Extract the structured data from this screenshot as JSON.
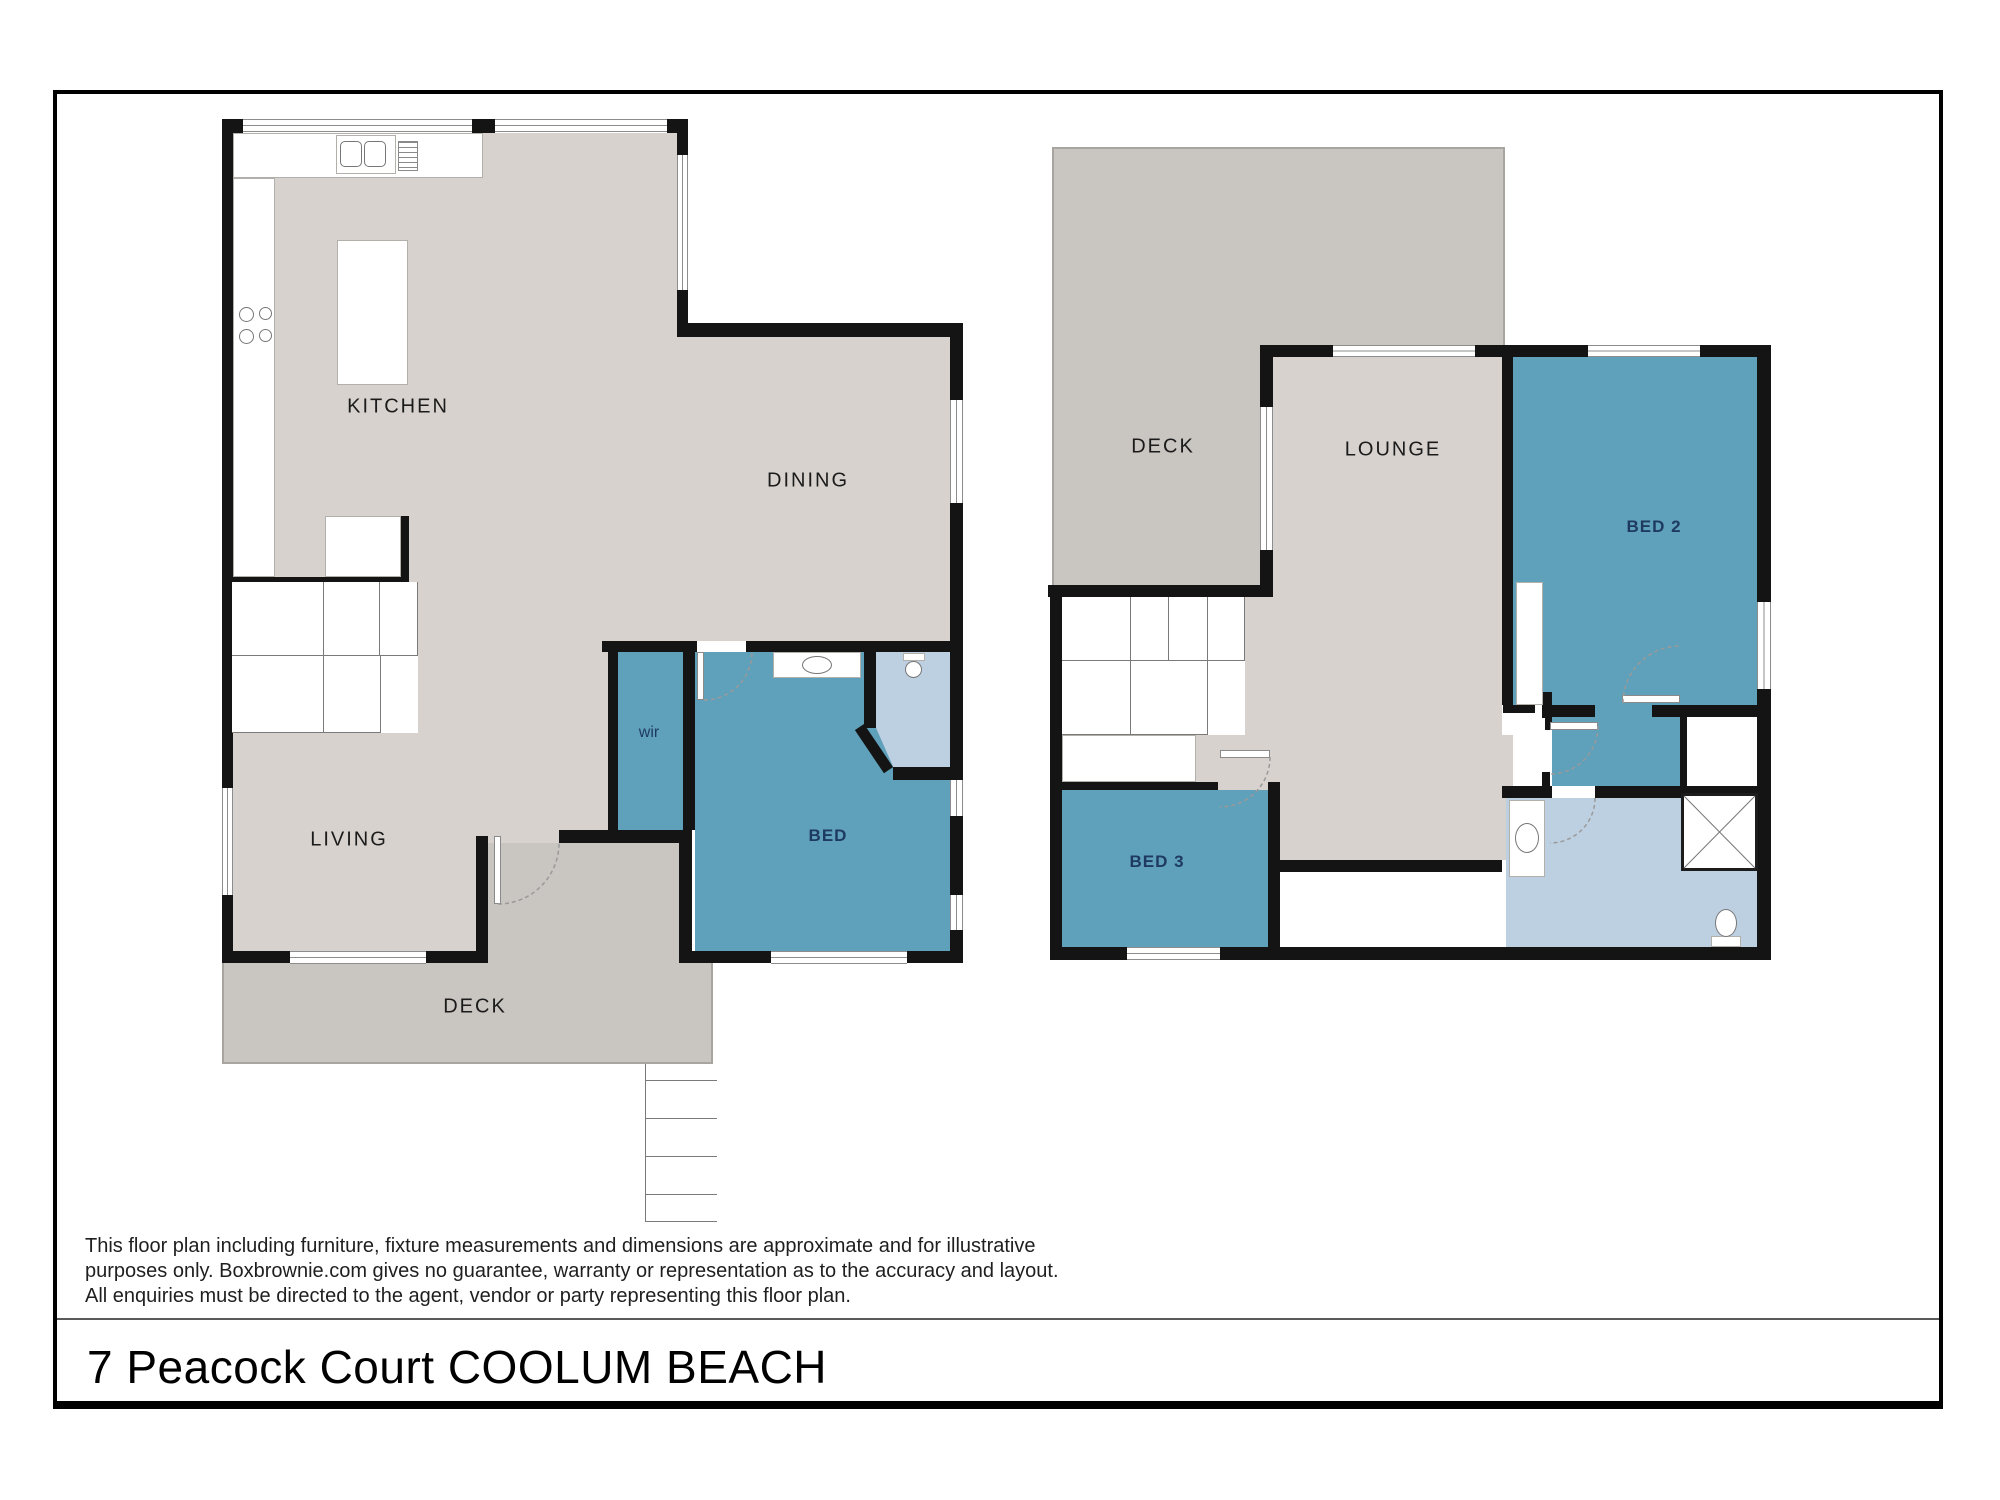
{
  "title": "7 Peacock Court COOLUM BEACH",
  "disclaimer": {
    "line1": "This floor plan including furniture, fixture measurements and dimensions are approximate and for illustrative",
    "line2": "purposes only. Boxbrownie.com gives no guarantee, warranty or representation as to the accuracy and layout.",
    "line3": "All enquiries must be directed to the agent, vendor or party representing this floor plan."
  },
  "ground_floor": {
    "labels": {
      "kitchen": "KITCHEN",
      "dining": "DINING",
      "living": "LIVING",
      "deck": "DECK",
      "wir": "wir",
      "bed": "BED"
    }
  },
  "upper_floor": {
    "labels": {
      "deck": "DECK",
      "lounge": "LOUNGE",
      "bed2": "BED 2",
      "bed3": "BED 3"
    }
  },
  "colors": {
    "wall": "#141414",
    "floor": "#d7d2ce",
    "deck": "#c9c5c1",
    "deck_edge": "#a8a49f",
    "teal": "#5fa0ba",
    "bath": "#bdd0e2",
    "navy": "#1e3a5f",
    "line": "#7a7a7a"
  }
}
